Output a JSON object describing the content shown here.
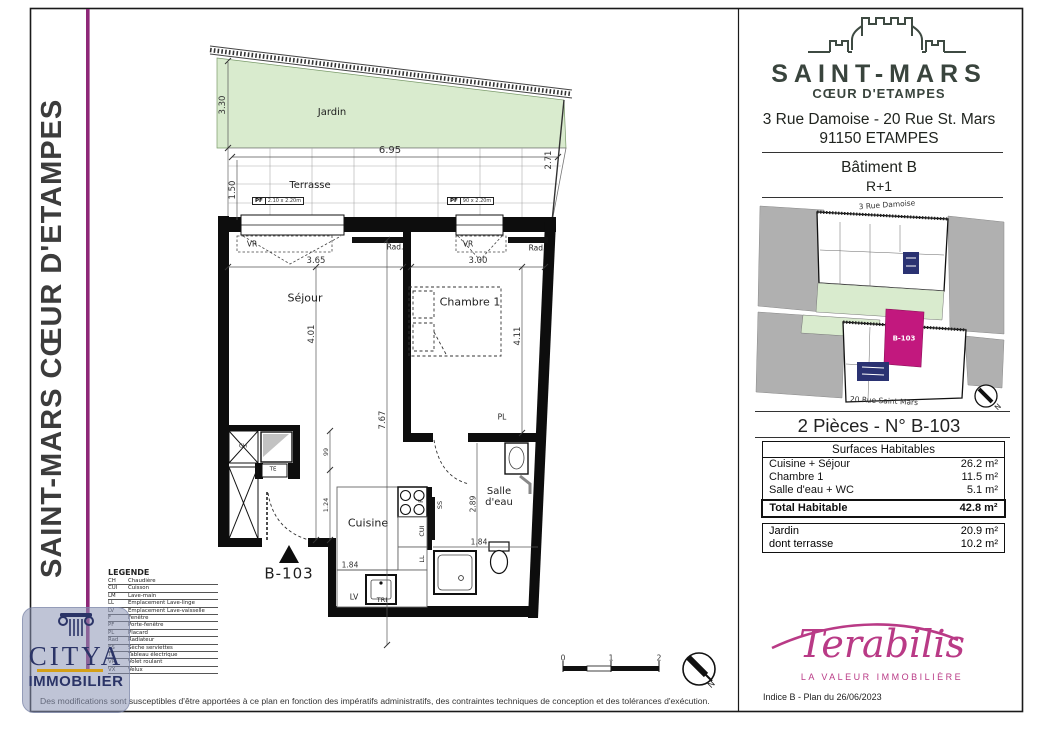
{
  "banner": {
    "title": "SAINT-MARS CŒUR D'ETAMPES"
  },
  "header": {
    "project_name": "SAINT-MARS",
    "project_subtitle": "CŒUR D'ETAMPES",
    "address_line1": "3 Rue Damoise - 20 Rue St. Mars",
    "address_line2": "91150 ETAMPES",
    "building": "Bâtiment B",
    "floor": "R+1"
  },
  "site_plan": {
    "street_top": "3 Rue Damoise",
    "street_bottom": "20 Rue Saint Mars",
    "unit": "B-103",
    "north": "N"
  },
  "unit_title": "2 Pièces - N° B-103",
  "surfaces": {
    "header": "Surfaces Habitables",
    "rows": [
      {
        "label": "Cuisine + Séjour",
        "value": "26.2 m²"
      },
      {
        "label": "Chambre 1",
        "value": "11.5 m²"
      },
      {
        "label": "Salle d'eau + WC",
        "value": "5.1 m²"
      }
    ],
    "total": {
      "label": "Total Habitable",
      "value": "42.8 m²"
    },
    "outdoor": [
      {
        "label": "Jardin",
        "value": "20.9 m²"
      },
      {
        "label": "dont terrasse",
        "value": "10.2 m²"
      }
    ]
  },
  "plan": {
    "rooms": {
      "jardin": "Jardin",
      "terrasse": "Terrasse",
      "sejour": "Séjour",
      "chambre": "Chambre 1",
      "cuisine": "Cuisine",
      "salle_deau": "Salle d'eau"
    },
    "unit": "B-103",
    "dims": {
      "d330": "3.30",
      "d150": "1.50",
      "d695": "6.95",
      "d271": "2.71",
      "d365": "3.65",
      "d300": "3.00",
      "d401": "4.01",
      "d411": "4.11",
      "d767": "7.67",
      "d99": "99",
      "d124": "1.24",
      "d184a": "1.84",
      "d184b": "1.84",
      "d289": "2.89"
    },
    "ann": {
      "vr": "VR",
      "rad": "Rad.",
      "pf": "PF",
      "pf1_size": "2.10 x 2.20m",
      "pf2_size": "90 x 2.20m",
      "ch": "CH",
      "te": "TE",
      "f": "F",
      "ss": "SS",
      "cui": "CUI",
      "ll": "LL",
      "lv": "LV",
      "tri": "TRI",
      "pl": "PL"
    },
    "scale": {
      "t0": "0",
      "t1": "1",
      "t2": "2",
      "north": "N"
    }
  },
  "legend": {
    "title": "LEGENDE",
    "items": [
      {
        "abbr": "CH",
        "label": "Chaudière"
      },
      {
        "abbr": "CUI",
        "label": "Cuisson"
      },
      {
        "abbr": "LM",
        "label": "Lave-main"
      },
      {
        "abbr": "LL",
        "label": "Emplacement Lave-linge"
      },
      {
        "abbr": "LV",
        "label": "Emplacement Lave-vaisselle"
      },
      {
        "abbr": "F",
        "label": "Fenêtre"
      },
      {
        "abbr": "PF",
        "label": "Porte-fenêtre"
      },
      {
        "abbr": "PL",
        "label": "Placard"
      },
      {
        "abbr": "Rad",
        "label": "Radiateur"
      },
      {
        "abbr": "SS",
        "label": "Sèche serviettes"
      },
      {
        "abbr": "TE",
        "label": "Tableau électrique"
      },
      {
        "abbr": "VR",
        "label": "Volet roulant"
      },
      {
        "abbr": "VX",
        "label": "Velux"
      }
    ]
  },
  "citya": {
    "name": "CITYA",
    "subtitle": "IMMOBILIER"
  },
  "terabilis": {
    "name": "Terabilis",
    "tagline": "LA VALEUR IMMOBILIÈRE"
  },
  "revision": "Indice B  - Plan du 26/06/2023",
  "disclaimer": "Des modifications sont susceptibles d'être apportées à ce plan en fonction des impératifs administratifs, des contraintes techniques de conception et des tolérances d'exécution.",
  "colors": {
    "highlight_magenta": "#c2187e",
    "banner_line": "#8e2878",
    "garden_green": "#d9ebce",
    "terabilis_pink": "#b93a86",
    "citya_navy": "#2b3467",
    "core_blue": "#2a3272"
  }
}
